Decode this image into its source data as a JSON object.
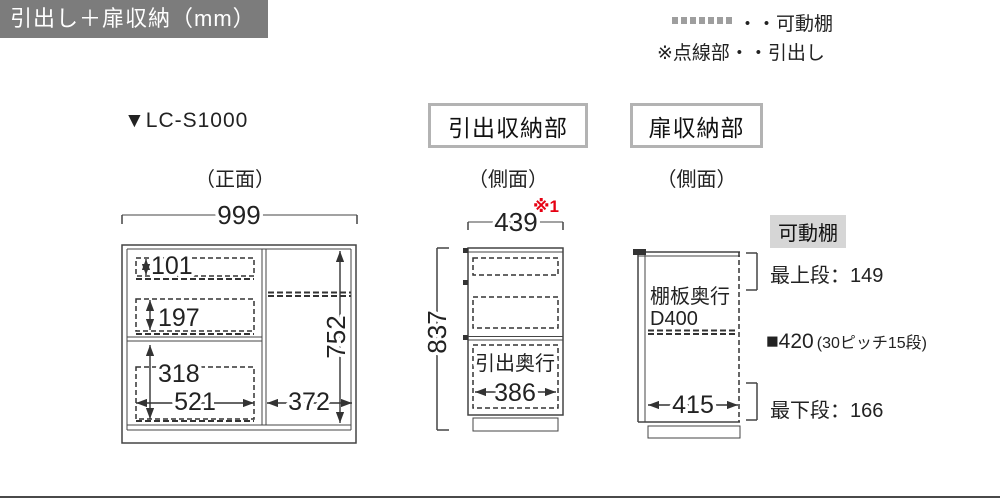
{
  "header": {
    "title": "引出し＋扉収納（mm）"
  },
  "legend": {
    "shelf_label": "・・可動棚",
    "drawer_note": "※点線部・・引出し"
  },
  "front_view": {
    "model": "▼LC-S1000",
    "view_label": "（正面）",
    "width_total": "999",
    "drawer1_height": "101",
    "drawer2_height": "197",
    "drawer3_height": "318",
    "drawer3_width": "521",
    "door_inner_height": "752",
    "door_inner_width": "372"
  },
  "drawer_section": {
    "title": "引出収納部",
    "view_label": "（側面）",
    "note_ref": "※1",
    "depth_total": "439",
    "height_total": "837",
    "drawer_depth_label": "引出奥行",
    "drawer_depth": "386"
  },
  "door_section": {
    "title": "扉収納部",
    "view_label": "（側面）",
    "shelf_depth_label1": "棚板奥行",
    "shelf_depth_label2": "D400",
    "inner_depth": "415",
    "shelf_tag": "可動棚",
    "top_row": "最上段：149",
    "pitch_value": "■420",
    "pitch_note": "(30ピッチ15段)",
    "bottom_row": "最下段：166"
  },
  "colors": {
    "accent_red": "#e60012",
    "header_bg": "#7c7c7c",
    "tag_bg": "#d6d6d6",
    "line": "#444444"
  }
}
